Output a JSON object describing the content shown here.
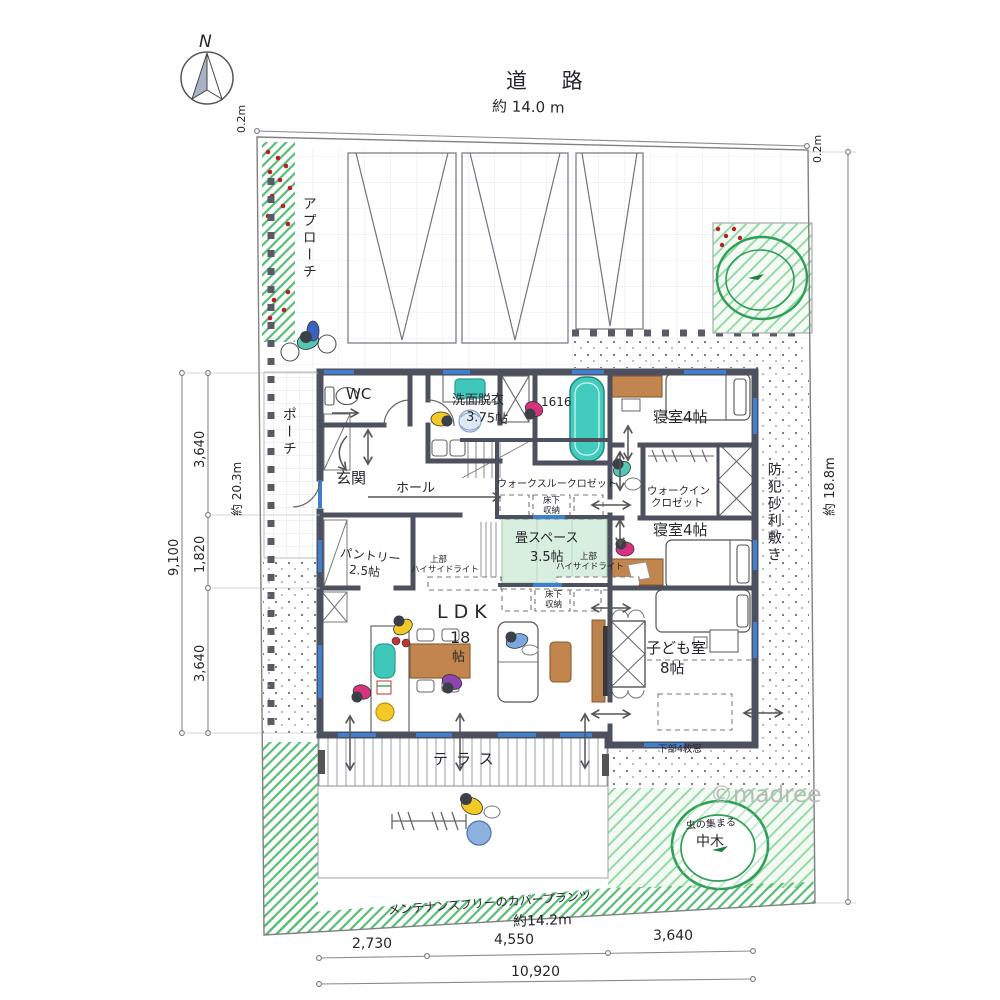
{
  "site": {
    "north": "N",
    "road": "道 路",
    "copyright": "©madree",
    "dimensions": {
      "top_width": "約 14.0 m",
      "top_left_offset": "0.2m",
      "top_right_offset": "0.2m",
      "left_depth": "約 20.3m",
      "left_seg_a": "3,640",
      "left_seg_b": "1,820",
      "left_seg_c": "3,640",
      "left_total": "9,100",
      "right_depth": "約 18.8m",
      "bottom_width": "約14.2m",
      "bottom_seg_a": "2,730",
      "bottom_seg_b": "4,550",
      "bottom_seg_c": "3,640",
      "bottom_total": "10,920"
    },
    "exterior_labels": {
      "approach": "アプローチ",
      "security_gravel": "防犯砂利敷き",
      "cover_plants": "メンテナンスフリーのカバープランツ",
      "tree_note_line1": "虫の集まる",
      "tree_note_line2": "中木",
      "terrace": "テラス",
      "lower_window_note": "下部4枚窓"
    }
  },
  "rooms": {
    "porch": "ポーチ",
    "wc": "WC",
    "entrance": "玄関",
    "hall": "ホール",
    "washroom": "洗面脱衣",
    "washroom_size": "3.75帖",
    "bath_size": "1616",
    "bedroom_north": "寝室4帖",
    "bedroom_south": "寝室4帖",
    "walkthrough_closet": "ウォークスルークロゼット",
    "walkin_closet_line1": "ウォークイン",
    "walkin_closet_line2": "クロゼット",
    "tatami_space": "畳スペース",
    "tatami_size": "3.5帖",
    "pantry": "パントリー",
    "pantry_size": "2.5帖",
    "ldk": "LDK",
    "ldk_size_num": "18",
    "ldk_size_unit": "帖",
    "kids_room": "子ども室",
    "kids_size": "8帖",
    "underfloor_line1": "床下",
    "underfloor_line2": "収納",
    "highside_line1": "上部",
    "highside_line2": "ハイサイドライト"
  },
  "colors": {
    "wall": "#4d505e",
    "window_blue": "#3f7fd0",
    "fixture_teal": "#42ccbe",
    "wood": "#c2854e",
    "tatami_green": "#d8eede",
    "garden_green": "#58bd74"
  }
}
